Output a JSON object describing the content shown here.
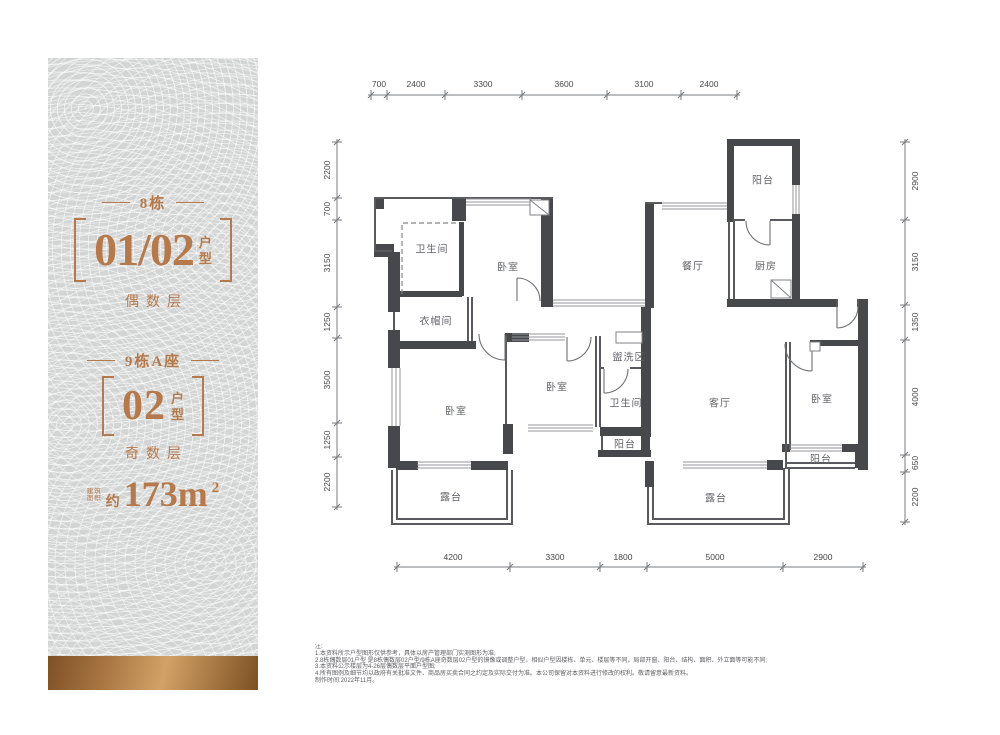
{
  "panel": {
    "section1": {
      "title": "8栋",
      "code": "01/02",
      "suffix": [
        "户",
        "型"
      ],
      "floor": "偶数层"
    },
    "section2": {
      "title": "9栋A座",
      "code": "02",
      "suffix": [
        "户",
        "型"
      ],
      "floor": "奇数层"
    },
    "area": {
      "label_lines": [
        "建筑",
        "面积"
      ],
      "approx": "约",
      "value": "173m",
      "sup": "2"
    }
  },
  "colors": {
    "copper": "#b5794c",
    "panel_bg": "#d3d5d4",
    "wall": "#47484c"
  },
  "plan": {
    "rooms": {
      "bath_tl": "卫生间",
      "bed_t": "卧室",
      "cloak": "衣帽间",
      "dining": "餐厅",
      "kitchen": "厨房",
      "balc_t": "阳台",
      "bed_m": "卧室",
      "wash": "盥洗区",
      "bath_m": "卫生间",
      "balc_m": "阳台",
      "living": "客厅",
      "bed_l": "卧室",
      "terr_l": "露台",
      "bed_r": "卧室",
      "balc_r": "阳台",
      "terr_c": "露台"
    },
    "dims": {
      "top": [
        "700",
        "2400",
        "3300",
        "3600",
        "3100",
        "2400"
      ],
      "bottom": [
        "4200",
        "3300",
        "1800",
        "5000",
        "2900"
      ],
      "left": [
        "2200",
        "700",
        "3150",
        "1250",
        "3500",
        "1250",
        "2200"
      ],
      "right": [
        "2900",
        "3150",
        "1350",
        "4000",
        "650",
        "2200"
      ]
    }
  },
  "notes": {
    "lines": [
      "注:",
      "1.本资料所示户型图形仅供参考，具体以房产管理部门实测图形为准;",
      "2.8栋偶数层01户型 是8栋偶数层02户型/9栋A座奇数层02户型的镜像或调整户型，相似户型因楼栋、单元、楼层等不同，局部开窗、阳台、结构、面积、外立面等可能不同;",
      "3.本资料公示楼层为4-26层偶数层平面户型图;",
      "4.所有图例及细节均以政府有关批准文件、商品房买卖合同之约定及实际交付为准。本公司保留对本资料进行修改的权利。敬请留意最新资料。",
      "制作时间:2022年11月。"
    ]
  }
}
